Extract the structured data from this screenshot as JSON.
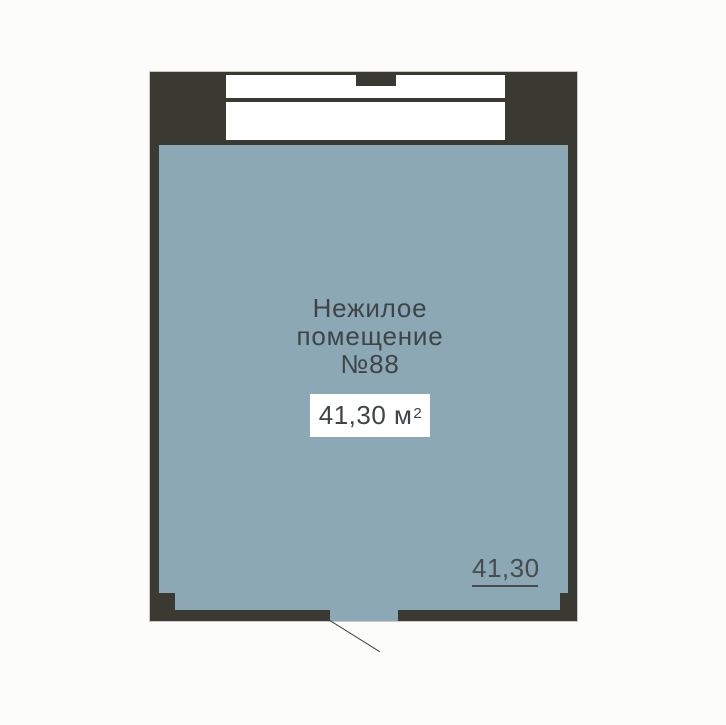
{
  "floorplan": {
    "room": {
      "label_line1": "Нежилое",
      "label_line2": "помещение",
      "number": "№88",
      "area_box": {
        "value": "41,30 м",
        "superscript": "2"
      },
      "dimension_label": "41,30"
    },
    "colors": {
      "wall": "#3a3a33",
      "room_fill": "#8ba8b4",
      "window_fill": "#ffffff",
      "text": "#3f4448",
      "background": "#fcfcfb",
      "area_box_background": "#ffffff"
    }
  }
}
